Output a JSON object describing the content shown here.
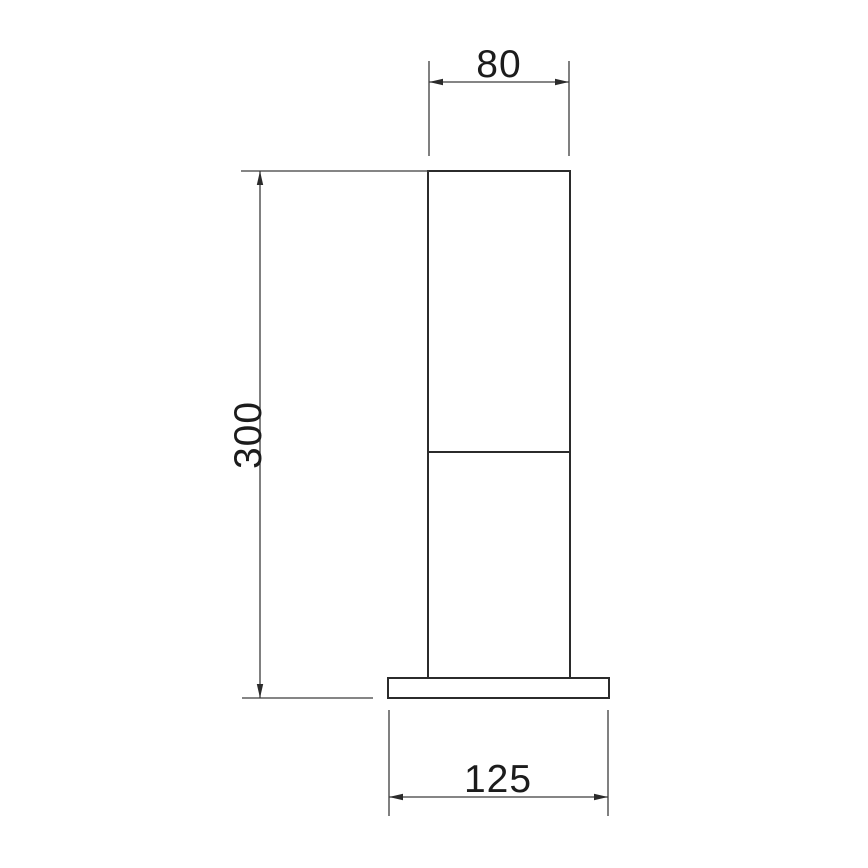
{
  "drawing": {
    "kind": "technical-dimension-drawing",
    "view": "front-elevation",
    "background_color": "#ffffff",
    "line_color": "#2b2b2b",
    "text_color": "#1c1c1c"
  },
  "dimensions": {
    "column_width": {
      "label": "80"
    },
    "overall_height": {
      "label": "300"
    },
    "base_width": {
      "label": "125"
    }
  }
}
